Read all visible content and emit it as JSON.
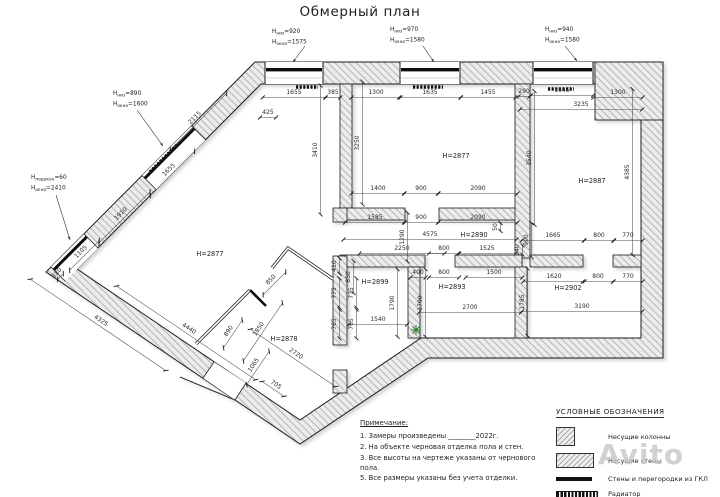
{
  "title": "Обмерный план",
  "watermark": "Avito",
  "colors": {
    "line": "#222222",
    "dim_text": "#2a2a2a",
    "wall_fill": "#ececec",
    "hatch": "#909090",
    "radiator": "#111111",
    "green_marker": "#2e7d32",
    "watermark_gray": "#c6c6c6"
  },
  "notes": {
    "heading": "Примечание:",
    "items": [
      "1. Замеры произведены ________2022г.",
      "2. На объекте черновая отделка пола и стен.",
      "3. Все высоты на чертеже указаны от чернового пола.",
      "5. Все размеры указаны без учета отделки."
    ]
  },
  "legend": {
    "heading": "УСЛОВНЫЕ ОБОЗНАЧЕНИЯ",
    "items": [
      {
        "label": "Несущие колонны",
        "swatch": "column"
      },
      {
        "label": "Несущие стены",
        "swatch": "wall"
      },
      {
        "label": "Стены и перегородки из ГКЛ",
        "swatch": "gkl"
      },
      {
        "label": "Радиатор",
        "swatch": "radiator"
      }
    ]
  },
  "plan": {
    "rooms": [
      [
        "H=2877",
        210,
        256
      ],
      [
        "H=2877",
        456,
        158
      ],
      [
        "H=2887",
        592,
        183
      ],
      [
        "H=2890",
        474,
        237
      ],
      [
        "H=2899",
        375,
        284
      ],
      [
        "H=2893",
        452,
        289
      ],
      [
        "H=2902",
        568,
        290
      ],
      [
        "H=2878",
        284,
        341
      ]
    ],
    "dims": [
      [
        "1655",
        294,
        94,
        0
      ],
      [
        "385",
        333,
        94,
        0
      ],
      [
        "425",
        268,
        114,
        0
      ],
      [
        "1300",
        376,
        94,
        0
      ],
      [
        "1635",
        430,
        94,
        0
      ],
      [
        "1455",
        488,
        94,
        0
      ],
      [
        "290",
        524,
        93,
        0
      ],
      [
        "1645",
        562,
        92,
        0
      ],
      [
        "1300",
        618,
        94,
        0
      ],
      [
        "3235",
        581,
        106,
        0
      ],
      [
        "3410",
        317,
        150,
        -90
      ],
      [
        "3250",
        359,
        143,
        -90
      ],
      [
        "3540",
        531,
        158,
        -90
      ],
      [
        "4385",
        629,
        172,
        -90
      ],
      [
        "1400",
        378,
        190,
        0
      ],
      [
        "900",
        421,
        190,
        0
      ],
      [
        "2090",
        478,
        190,
        0
      ],
      [
        "1585",
        375,
        219,
        0
      ],
      [
        "900",
        421,
        219,
        0
      ],
      [
        "2090",
        478,
        219,
        0
      ],
      [
        "50",
        497,
        227,
        -90
      ],
      [
        "1290",
        404,
        237,
        -90
      ],
      [
        "4575",
        430,
        236,
        0
      ],
      [
        "900",
        528,
        240,
        -90
      ],
      [
        "1665",
        553,
        237,
        0
      ],
      [
        "800",
        599,
        237,
        0
      ],
      [
        "770",
        628,
        237,
        0
      ],
      [
        "2250",
        402,
        250,
        0
      ],
      [
        "800",
        444,
        250,
        0
      ],
      [
        "1525",
        487,
        250,
        0
      ],
      [
        "240",
        519,
        250,
        -90
      ],
      [
        "400",
        418,
        274,
        0
      ],
      [
        "800",
        444,
        274,
        0
      ],
      [
        "1500",
        494,
        274,
        0
      ],
      [
        "1620",
        554,
        278,
        0
      ],
      [
        "800",
        598,
        278,
        0
      ],
      [
        "770",
        628,
        278,
        0
      ],
      [
        "3190",
        582,
        308,
        0
      ],
      [
        "2700",
        470,
        309,
        0
      ],
      [
        "1540",
        378,
        321,
        0
      ],
      [
        "1790",
        394,
        303,
        -90
      ],
      [
        "1790",
        422,
        303,
        -90
      ],
      [
        "1785",
        524,
        302,
        -90
      ],
      [
        "410",
        336,
        266,
        -90
      ],
      [
        "850",
        350,
        277,
        -90
      ],
      [
        "775",
        336,
        293,
        -90
      ],
      [
        "775",
        353,
        293,
        -90
      ],
      [
        "765",
        336,
        324,
        -90
      ],
      [
        "765",
        353,
        324,
        -90
      ],
      [
        "2115",
        196,
        119,
        -45
      ],
      [
        "1655",
        170,
        171,
        -45
      ],
      [
        "1910",
        122,
        215,
        -45
      ],
      [
        "1105",
        82,
        253,
        -45
      ],
      [
        "180",
        58,
        274,
        -45
      ],
      [
        "4325",
        100,
        322,
        34
      ],
      [
        "4440",
        188,
        330,
        34
      ],
      [
        "890",
        230,
        332,
        -56
      ],
      [
        "1850",
        260,
        330,
        -56
      ],
      [
        "1065",
        255,
        366,
        -56
      ],
      [
        "2720",
        295,
        355,
        34
      ],
      [
        "705",
        275,
        386,
        34
      ],
      [
        "850",
        272,
        281,
        -45
      ]
    ],
    "window_labels": [
      {
        "x": 272,
        "y": 33,
        "leader": [
          305,
          46,
          293,
          62
        ],
        "rows": [
          {
            "pre": "H",
            "sub": "низ",
            "post": "=920"
          },
          {
            "pre": "H",
            "sub": "окна",
            "post": "=1575"
          }
        ]
      },
      {
        "x": 390,
        "y": 31,
        "leader": [
          423,
          46,
          434,
          62
        ],
        "rows": [
          {
            "pre": "H",
            "sub": "низ",
            "post": "=970"
          },
          {
            "pre": "H",
            "sub": "окна",
            "post": "=1580"
          }
        ]
      },
      {
        "x": 545,
        "y": 31,
        "leader": [
          565,
          46,
          577,
          61
        ],
        "rows": [
          {
            "pre": "H",
            "sub": "низ",
            "post": "=940"
          },
          {
            "pre": "H",
            "sub": "окна",
            "post": "=1580"
          }
        ]
      },
      {
        "x": 113,
        "y": 95,
        "leader": [
          137,
          110,
          163,
          146
        ],
        "rows": [
          {
            "pre": "H",
            "sub": "низ",
            "post": "=890"
          },
          {
            "pre": "H",
            "sub": "окна",
            "post": "=1600"
          }
        ]
      },
      {
        "x": 31,
        "y": 179,
        "leader": [
          56,
          195,
          70,
          240
        ],
        "rows": [
          {
            "pre": "H",
            "sub": "подокон",
            "post": "=60"
          },
          {
            "pre": "H",
            "sub": "окна",
            "post": "=2410"
          }
        ]
      }
    ]
  }
}
